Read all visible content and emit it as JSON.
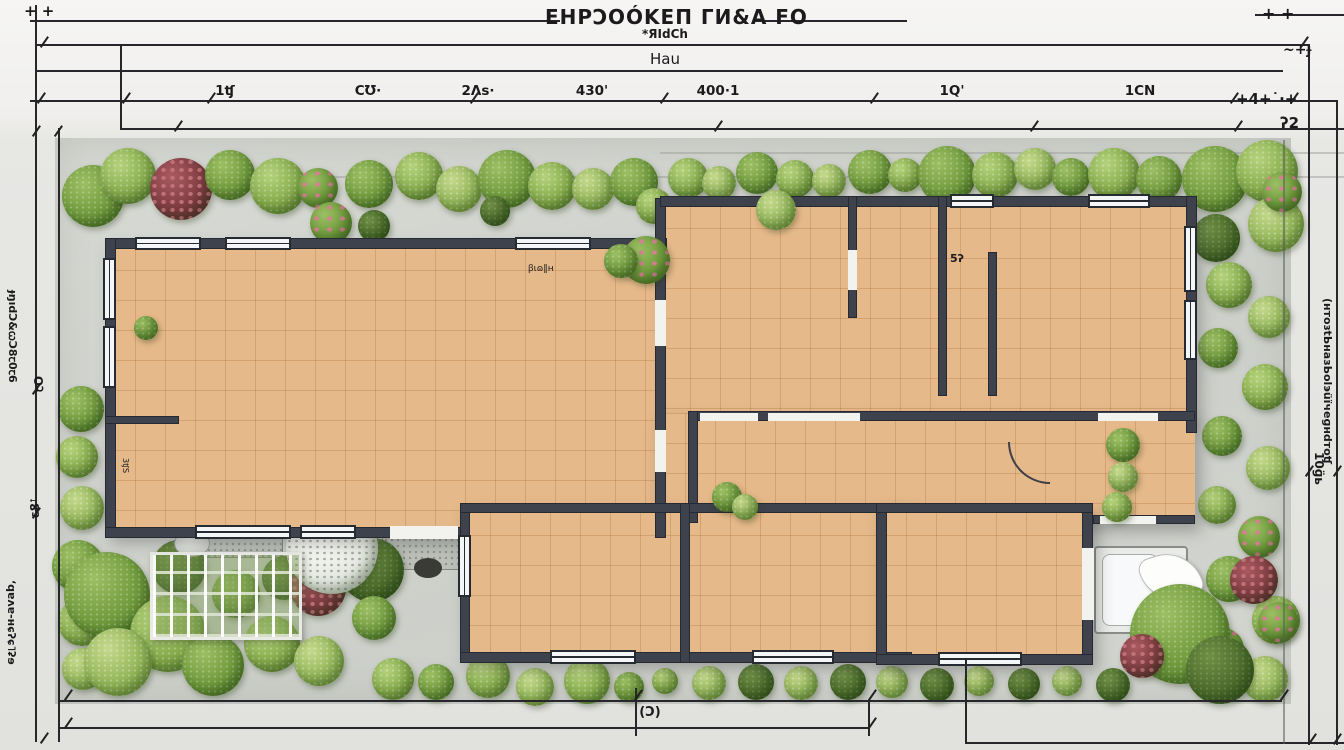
{
  "title": {
    "main": "EHPϽOÓKЕП ГИ&А FO",
    "sub": "*ЯIdCh",
    "sub2": "Hau"
  },
  "dims": {
    "top": [
      "1ʧ",
      "CƱ·",
      "2Ʌs·",
      "430'",
      "400·1",
      "1Q'",
      "1CN"
    ],
    "corner_tl": "+ +",
    "corner_tr_1": "+ +",
    "corner_tr_2": "~+ɟ",
    "corner_tr_3": "+4+˙·+",
    "corner_tr_4": "ʔ2",
    "bottom_label": "(Ɔ)",
    "left_num1": "ꞇO",
    "left_num2": "ɛ8ꜛ",
    "left_text_upper": "ɟŋıdƆ&ꞷƆ8ꞇ0ꞇ6",
    "left_text_lower": "ʻqɐʌɐ-ʜɕʔɕ˥ʡɘ",
    "right_text": "(ʜтоɜtЬназЬоlэüïчеɡнdтоʧ",
    "right_num": "10ɡ̈ь"
  },
  "plan": {
    "bath_label": "5ʔ",
    "vanity_label": "3ʧS",
    "island_label": "ꞵɩɷ‖ʜ"
  }
}
